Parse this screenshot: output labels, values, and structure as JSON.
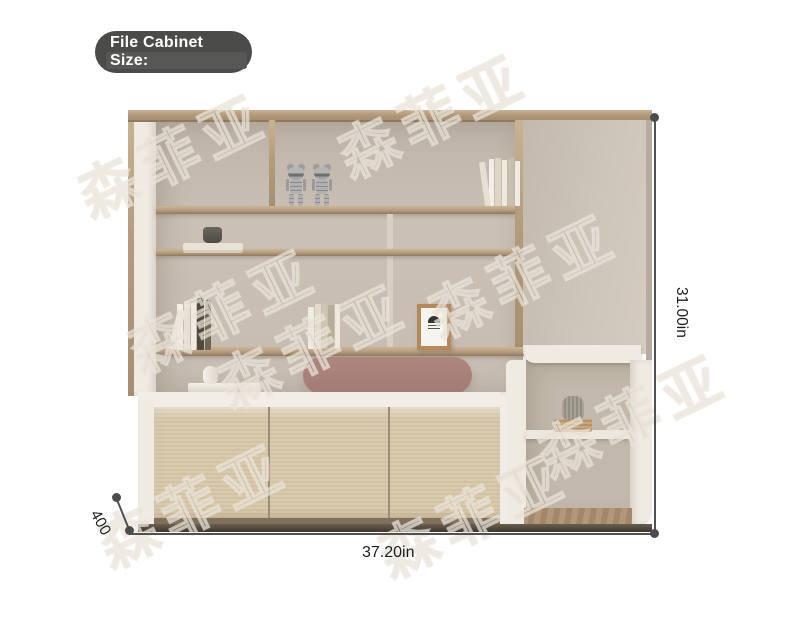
{
  "badge": {
    "line1": "File Cabinet",
    "line2": "Size:",
    "bg_color": "#4b4b49",
    "text_color": "#ffffff"
  },
  "dimensions": {
    "height_label": "31.00in",
    "width_label": "37.20in",
    "depth_label": "400",
    "line_color": "#515151",
    "text_color": "#1e1e1e"
  },
  "watermark": {
    "text": "森菲亚",
    "style": "outlined, rotated, repeated over image"
  },
  "furniture": {
    "description": "beige wall shelving unit with tall cabinet door, three-door wood sideboard, pink pill shelf and open side shelf",
    "colors": {
      "wood_shelf": "#b49b7e",
      "back_panel": "#c8beb2",
      "white_frame": "#efeae2",
      "tall_door": "#ccc3b7",
      "sideboard_doors": "#d8c8ab",
      "pink_pill_shelf": "#a5807a",
      "floor_strip": "#a98e6d"
    },
    "decor": [
      "bear-figurines",
      "books",
      "smoke-glass-cup",
      "picture-frame",
      "white-vase",
      "glass-vase-on-basket"
    ]
  }
}
